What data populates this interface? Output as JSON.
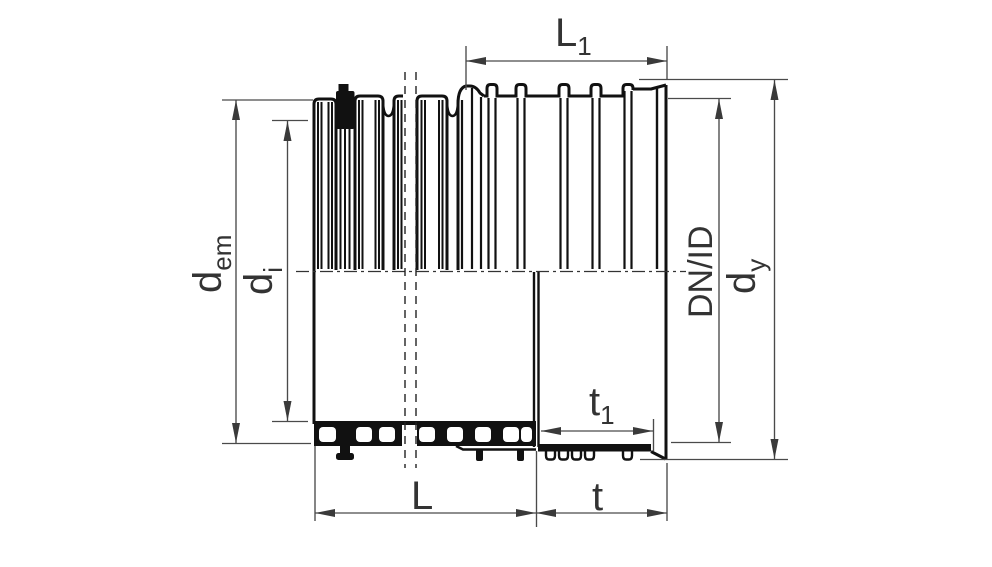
{
  "figure": {
    "type": "technical-drawing",
    "description": "Half-section drawing of a corrugated twin-wall pipe inserted into an integrated socket (bell) with sealing ring, annotated with dimensions",
    "background": "#ffffff",
    "colors": {
      "outline": "#111111",
      "thin_line": "#4a4a4a",
      "arrow": "#3a3a3a",
      "centerline": "#333333",
      "text": "#333333"
    }
  },
  "labels": {
    "l1": {
      "main": "L",
      "sub": "1"
    },
    "l": {
      "main": "L"
    },
    "t": {
      "main": "t"
    },
    "t1": {
      "main": "t",
      "sub": "1"
    },
    "d_em": {
      "main": "d",
      "sub": "em"
    },
    "d_i": {
      "main": "d",
      "sub": "i"
    },
    "dn_id": {
      "main": "DN/ID"
    },
    "d_y": {
      "main": "d",
      "sub": "y"
    }
  }
}
